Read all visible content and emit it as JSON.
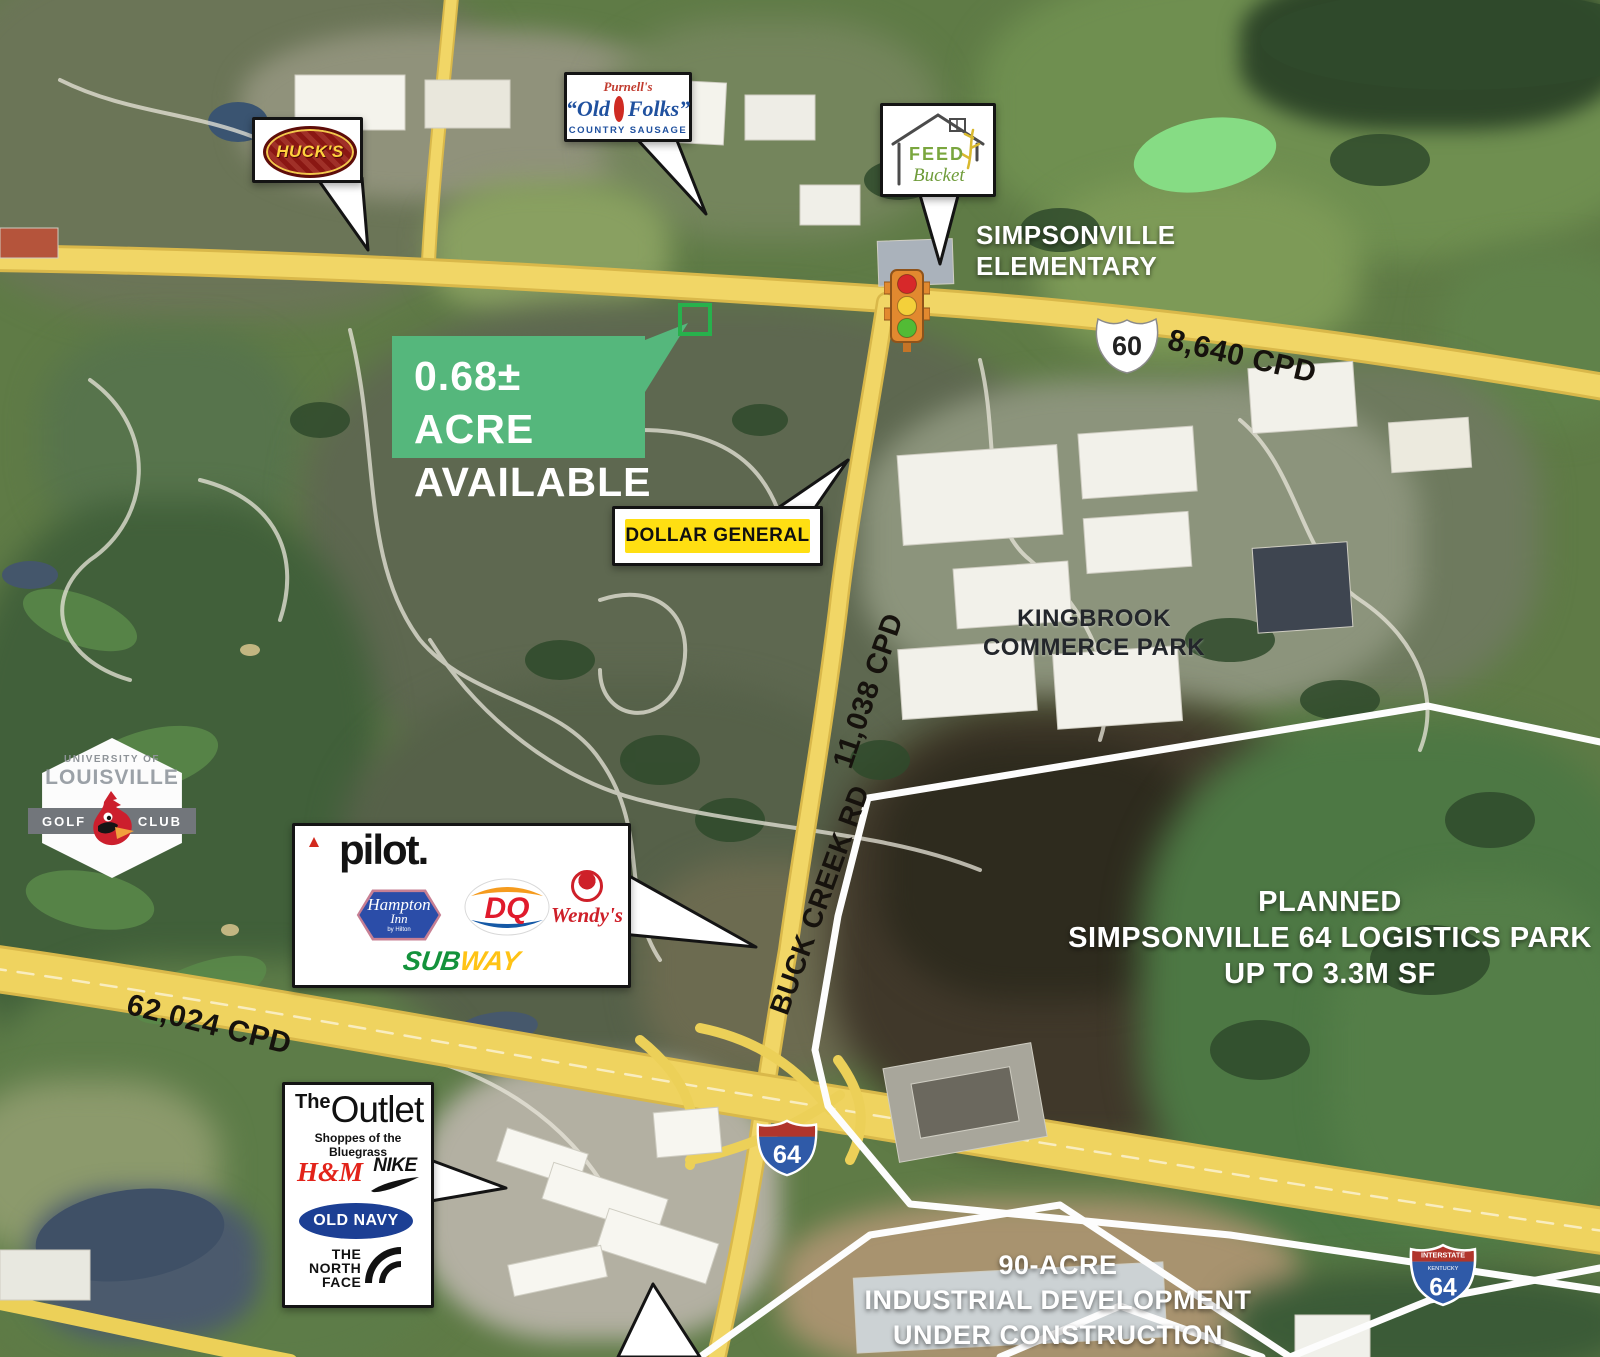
{
  "available_callout": {
    "line1": "0.68± ACRE",
    "line2": "AVAILABLE"
  },
  "road_labels": {
    "us60_cpd": "8,640 CPD",
    "buck_creek_cpd": "11,038 CPD",
    "i64_cpd": "62,024 CPD",
    "buck_creek_name": "BUCK CREEK RD"
  },
  "shields": {
    "us60_number": "60",
    "i64_number": "64",
    "i64_right": {
      "top": "INTERSTATE",
      "state": "KENTUCKY",
      "number": "64"
    }
  },
  "area_labels": {
    "school": {
      "line1": "SIMPSONVILLE",
      "line2": "ELEMENTARY"
    },
    "kingbrook": {
      "line1": "KINGBROOK",
      "line2": "COMMERCE PARK"
    },
    "logistics": {
      "line1": "PLANNED",
      "line2": "SIMPSONVILLE 64 LOGISTICS PARK",
      "line3": "UP TO 3.3M SF"
    },
    "industrial": {
      "line1": "90-ACRE",
      "line2": "INDUSTRIAL DEVELOPMENT",
      "line3": "UNDER CONSTRUCTION"
    }
  },
  "callouts": {
    "hucks": {
      "brand": "HUCK'S"
    },
    "old_folks": {
      "script": "Purnell's",
      "left": "“Old",
      "right": "Folks”",
      "sub": "COUNTRY SAUSAGE"
    },
    "feed_bucket": {
      "word1": "FEED",
      "word2": "Bucket"
    },
    "dollar_general": {
      "brand": "DOLLAR GENERAL"
    },
    "travel": {
      "pilot": "pilot.",
      "hampton_line1": "Hampton",
      "hampton_line2": "Inn",
      "hampton_sub": "by Hilton",
      "dq": "DQ",
      "wendys": "Wendy's",
      "subway_left": "SUB",
      "subway_right": "WAY"
    },
    "outlet": {
      "the": "The",
      "name": "Outlet",
      "sub": "Shoppes of the Bluegrass",
      "hm": "H&M",
      "nike": "NIKE",
      "old_navy": "OLD NAVY",
      "tnf1": "THE",
      "tnf2": "NORTH",
      "tnf3": "FACE"
    }
  },
  "golf_club": {
    "top": "UNIVERSITY OF",
    "name": "LOUISVILLE",
    "left": "GOLF",
    "right": "CLUB"
  },
  "colors": {
    "available_green": "#55b77c",
    "parcel_green": "#27b14c",
    "road_yellow": "#efd35f",
    "callout_border": "#141414",
    "shield_red": "#b0352c",
    "shield_blue": "#2f5aa8"
  }
}
